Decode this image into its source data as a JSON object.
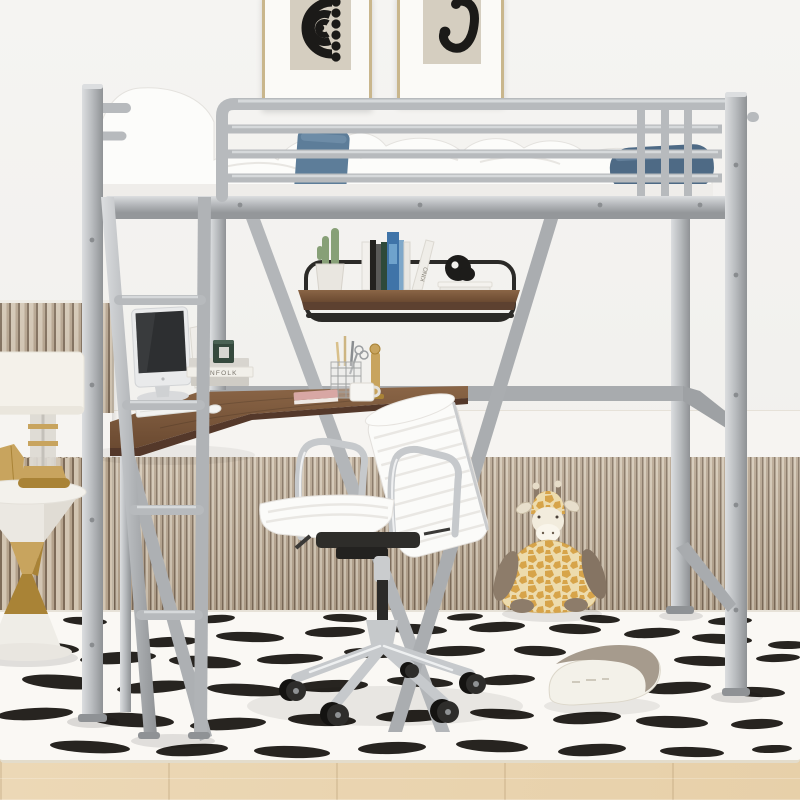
{
  "texts": {
    "book_stack_spine": "NFOLK",
    "shelf_leaning_book_spine": "KINO"
  },
  "palette": {
    "wall": "#f2f1ee",
    "molding": "#f6f4f1",
    "moldingedge": "#ddd6cb",
    "wainlight": "#d2c5b2",
    "wainmid": "#b4a28c",
    "waindark": "#7e6c59",
    "metal": "#b7babd",
    "metallight": "#dcdee0",
    "metaldark": "#8f9295",
    "wood": "#82603f",
    "wooddark": "#66482f",
    "woodedge": "#54382a",
    "rug": "#faf8f4",
    "spot": "#181510",
    "floor": "#ecd8b6",
    "denim": "#5d7d99",
    "denimdark": "#4e6a85",
    "bedwhite": "#fcfcfa",
    "chrome": "#c6c9cc",
    "gold": "#c8a45e",
    "golddark": "#a98336",
    "cactus": "#87a077",
    "pot": "#e9e6e0",
    "canister": "#35493d",
    "screen": "#2d2f31",
    "chairwhite": "#fbfbf9",
    "chairrib": "#e9e7e3",
    "mech": "#2e2d2a",
    "giraffegold": "#d7a44a",
    "giraffecream": "#eddcae",
    "giraffebrown": "#8d7c6a",
    "pillowgray": "#a69b8d",
    "pillowwhite": "#f3f1e9",
    "artpanel": "#d5cec0",
    "artink": "#1b1a18",
    "framegold": "#c9b68c",
    "shelfrail": "#2b2a27",
    "pinkbook": "#d8a7a4",
    "bookblue": "#3f74a8"
  }
}
